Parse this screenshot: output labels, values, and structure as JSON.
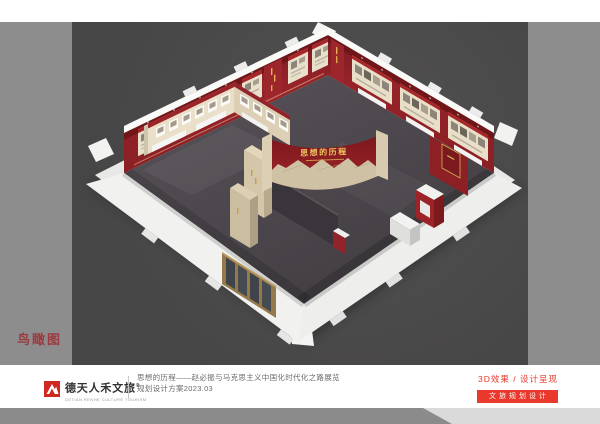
{
  "view": {
    "label": "鸟瞰图"
  },
  "scene": {
    "title_wall_text": "思想的历程"
  },
  "footer": {
    "brand": {
      "name": "德天人禾文旅",
      "mark": "®",
      "subtitle": "DETIAN RENHE CULTURE TOURISM"
    },
    "project": {
      "line1": "思想的历程——赵必振与马克思主义中国化时代化之路展览",
      "line2": "规划设计方案2023.03"
    },
    "meta": {
      "label": "3D效果 / 设计呈现",
      "badge": "文旅规划设计"
    }
  },
  "colors": {
    "brand_red": "#cf2a21",
    "accent_red": "#e8392c",
    "exhibit_wall_red": "#8e2024",
    "view_label_red": "#9d3a40",
    "gold": "#e3b455",
    "frame_gray": "#8d8d8d",
    "stage_gray": "#4a4a49"
  }
}
